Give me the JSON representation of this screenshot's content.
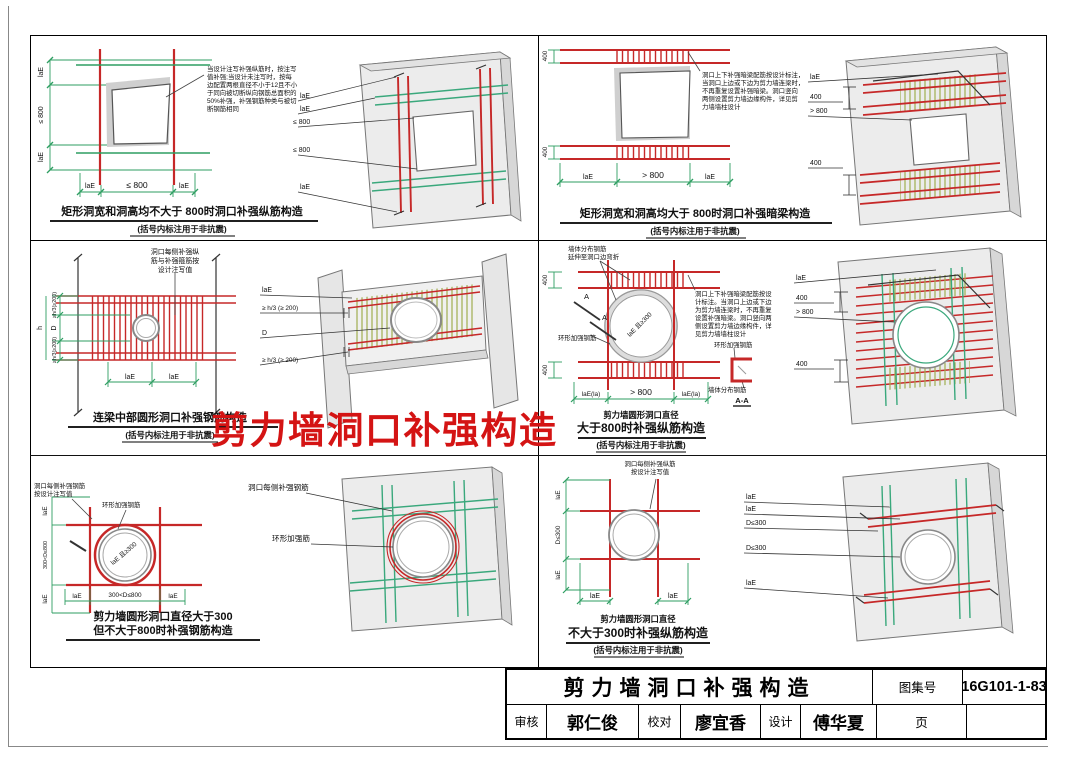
{
  "sheet": {
    "watermark": "剪力墙洞口补强构造"
  },
  "titleblock": {
    "title": "剪力墙洞口补强构造",
    "atlas_label": "图集号",
    "atlas_no": "16G101-1-83",
    "page_label": "页",
    "review_label": "审核",
    "review_name": "郭仁俊",
    "check_label": "校对",
    "check_name": "廖宜香",
    "design_label": "设计",
    "design_name": "傅华夏"
  },
  "p1": {
    "caption": "矩形洞宽和洞高均不大于 800时洞口补强纵筋构造",
    "subcaption": "(括号内标注用于非抗震)",
    "note": [
      "当设计注写补强纵筋时，按注写",
      "值补强;当设计未注写时，按每",
      "边配置两根直径不小于12且不小",
      "于同向被切断纵向钢筋总面积的",
      "50%补强，补强钢筋种类与被切",
      "断钢筋相同"
    ],
    "left_dims": [
      "laE",
      "≤ 800",
      "laE"
    ],
    "bot_dims": [
      "laE",
      "≤ 800",
      "laE"
    ],
    "view3d": [
      "laE",
      "laE",
      "≤ 800",
      "≤ 800",
      "laE"
    ]
  },
  "p2": {
    "caption": "矩形洞宽和洞高均大于 800时洞口补强暗梁构造",
    "subcaption": "(括号内标注用于非抗震)",
    "note": [
      "洞口上下补强暗梁配筋按设计标注，",
      "当洞口上边或下边为剪力墙连梁时，",
      "不再重复设置补强暗梁。洞口竖向",
      "两侧设置剪力墙边缘构件，详见剪",
      "力墙墙柱设计"
    ],
    "left_dims": [
      "400",
      "400"
    ],
    "bot_dims": [
      "laE",
      "> 800",
      "laE"
    ],
    "view3d": [
      "laE",
      "400",
      "> 800",
      "400"
    ]
  },
  "p3": {
    "caption": "连梁中部圆形洞口补强钢筋构造",
    "subcaption": "(括号内标注用于非抗震)",
    "note": [
      "洞口每侧补强纵",
      "筋与补强箍筋按",
      "设计注写值"
    ],
    "left_dims": [
      "≥h/3(≥200)",
      "D",
      "≥h/3(≥200)"
    ],
    "height_dim": "h",
    "bot_dims": [
      "laE",
      "laE"
    ],
    "view3d": [
      "laE",
      "≥ h/3 (≥ 200)",
      "D",
      "≥ h/3 (≥ 200)"
    ]
  },
  "p4": {
    "caption1": "剪力墙圆形洞口直径",
    "caption2": "大于800时补强纵筋构造",
    "subcaption": "(括号内标注用于非抗震)",
    "note_top": [
      "墙体分布钢筋",
      "延伸至洞口边弯折"
    ],
    "note": [
      "洞口上下补强暗梁配筋按设",
      "计标注。当洞口上边或下边",
      "为剪力墙连梁时，不再重复",
      "设置补强暗梁。洞口竖向两",
      "侧设置剪力墙边缘构件，详",
      "见剪力墙墙柱设计"
    ],
    "ring_label": "环形加强钢筋",
    "circle_text": "laE 且≥300",
    "section_letter": "A",
    "section": {
      "ring": "环形加强钢筋",
      "dist": "墙体分布钢筋",
      "name": "A-A"
    },
    "left_dims": [
      "400",
      "400"
    ],
    "bot_dims": [
      "laE(la)",
      "> 800",
      "laE(la)"
    ],
    "view3d": [
      "laE",
      "400",
      "> 800",
      "400"
    ]
  },
  "p5": {
    "caption1": "剪力墙圆形洞口直径大于300",
    "caption2": "但不大于800时补强钢筋构造",
    "note": [
      "洞口每侧补强钢筋",
      "按设计注写值"
    ],
    "ring_label": "环形加强钢筋",
    "circle_text": "laE 且≥300",
    "left_dims": [
      "laE",
      "300<D≤800",
      "laE"
    ],
    "bot_dims": [
      "laE",
      "300<D≤800",
      "laE"
    ],
    "labels3d": [
      "洞口每侧补强钢筋",
      "环形加强筋"
    ]
  },
  "p6": {
    "caption1": "剪力墙圆形洞口直径",
    "caption2": "不大于300时补强纵筋构造",
    "subcaption": "(括号内标注用于非抗震)",
    "note": [
      "洞口每侧补强纵筋",
      "按设计注写值"
    ],
    "left_dims": [
      "laE",
      "D≤300",
      "laE"
    ],
    "bot_dims": [
      "laE",
      "laE"
    ],
    "view3d": [
      "laE",
      "laE",
      "D≤300",
      "D≤300",
      "laE"
    ]
  }
}
